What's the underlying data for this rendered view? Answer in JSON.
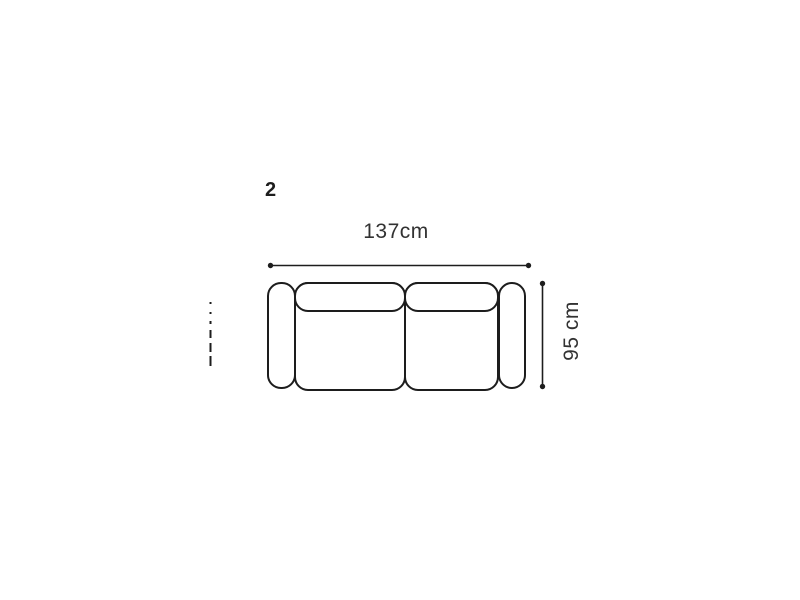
{
  "page": {
    "background_color": "#ffffff",
    "line_color": "#1d1d1d",
    "text_color": "#323232"
  },
  "diagram": {
    "item_label": "2",
    "width_dimension": "137cm",
    "depth_dimension": "95 cm"
  }
}
